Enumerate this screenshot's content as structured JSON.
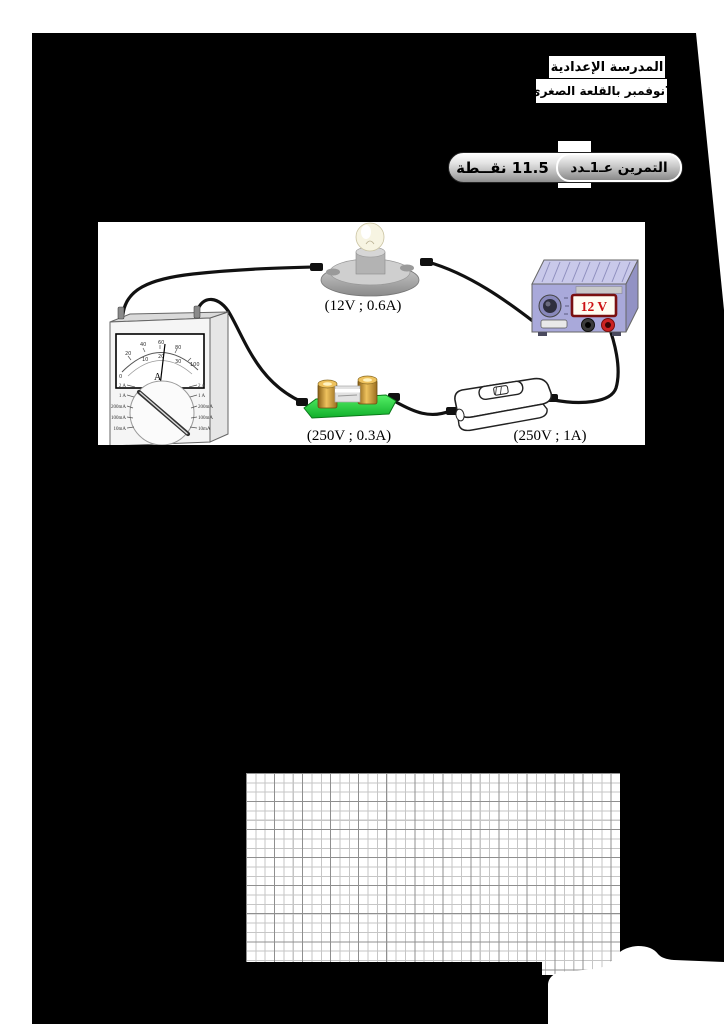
{
  "document": {
    "header": {
      "school_name_line1": "المدرسة الإعدادية",
      "school_name_line2": "7نوفمبر بالقلعة الصغرى"
    },
    "exercise": {
      "title": "التمرين عـ1ـدد",
      "points": "11.5 نقــطة"
    },
    "circuit": {
      "lamp_label": "(12V ; 0.6A)",
      "power_supply_display": "12 V",
      "fuse_label": "(250V ; 0.3A)",
      "switch_label": "(250V ; 1A)",
      "ammeter": {
        "unit": "A",
        "scale_outer": [
          "0",
          "20",
          "40",
          "60",
          "80",
          "100"
        ],
        "scale_inner": [
          "10",
          "20",
          "30"
        ],
        "ranges_left": [
          "2 A",
          "1 A",
          "200mA",
          "100mA",
          "10mA"
        ],
        "ranges_right": [
          "2 A",
          "1 A",
          "200mA",
          "100mA",
          "10mA"
        ]
      }
    },
    "colors": {
      "page_background": "#000000",
      "paper": "#ffffff",
      "fuse_green": "#2ed13d",
      "supply_body": "#a9a9da",
      "display_text_red": "#cc1111",
      "terminal_red": "#cc2222",
      "grid_minor": "#c6c6c6",
      "grid_major": "#8f8f8f"
    }
  }
}
